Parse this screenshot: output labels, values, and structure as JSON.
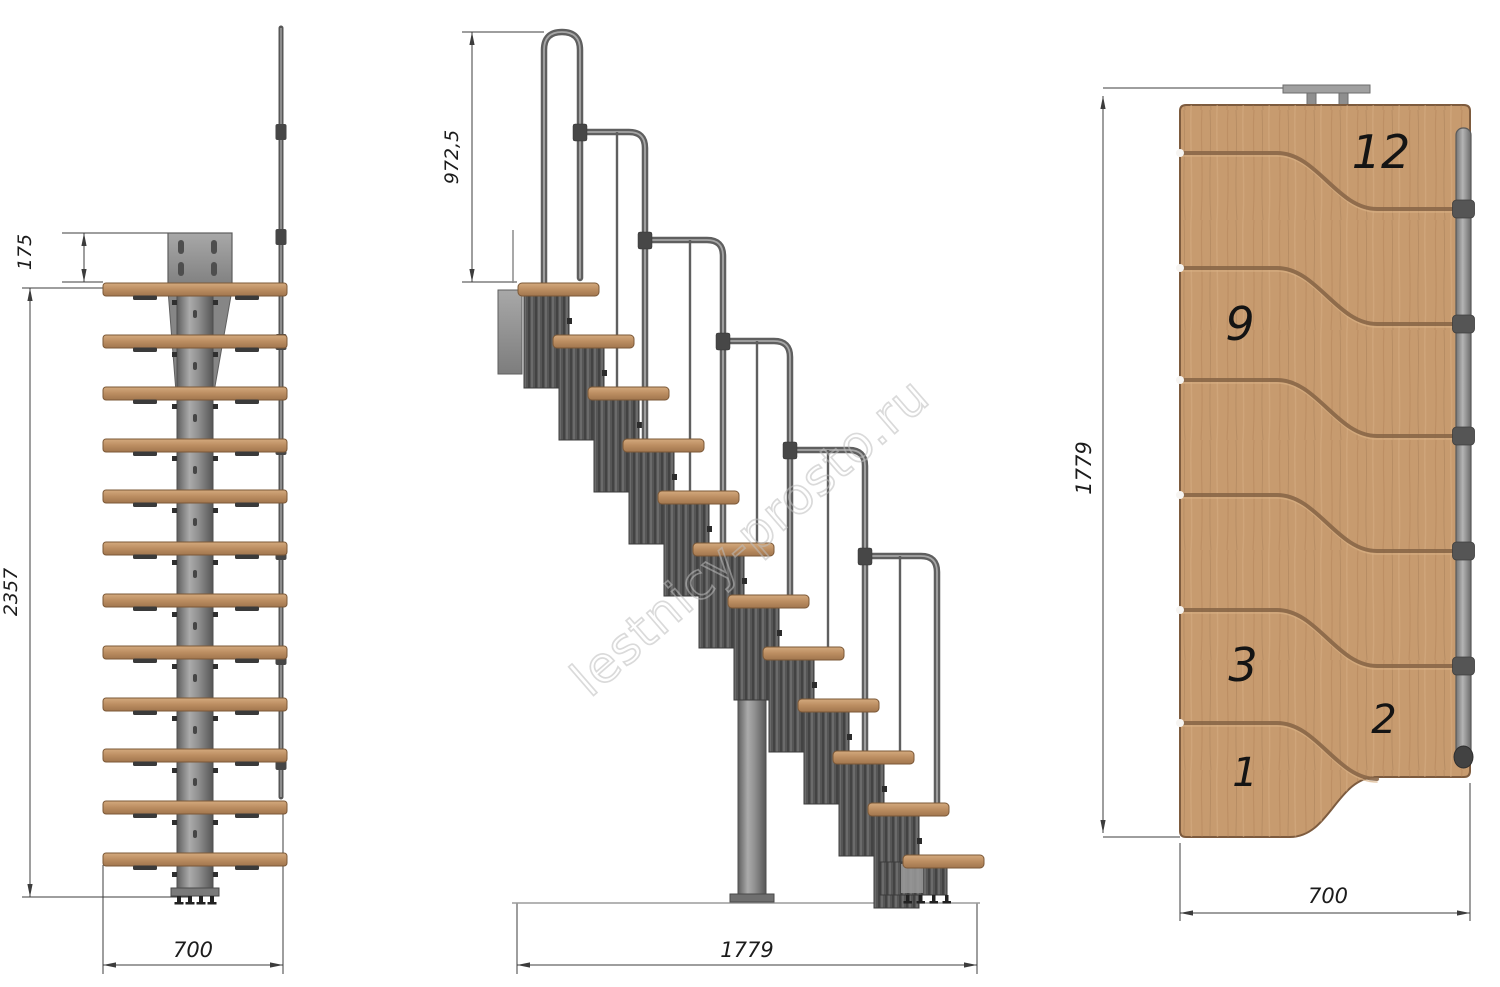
{
  "watermark": {
    "text": "lestnicy-prosto.ru"
  },
  "views": {
    "front": {
      "name": "front-elevation",
      "dims": {
        "offset_top": "175",
        "total_height": "2357",
        "width": "700"
      }
    },
    "side": {
      "name": "side-elevation",
      "dims": {
        "handrail_height": "972,5",
        "total_length": "1779"
      }
    },
    "plan": {
      "name": "top-plan",
      "dims": {
        "total_length": "1779",
        "width": "700"
      },
      "step_labels": [
        {
          "label": "12"
        },
        {
          "label": "9"
        },
        {
          "label": "3"
        },
        {
          "label": "2"
        },
        {
          "label": "1"
        }
      ]
    }
  },
  "colors": {
    "background": "#ffffff",
    "wood_base": "#c79b6f",
    "wood_tread_top": "#d4aa7e",
    "wood_tread_dark": "#a1764e",
    "wood_groove": "#8a6748",
    "metal_light": "#ababab",
    "metal_mid": "#8f8f8f",
    "metal_dark": "#5f5f5f",
    "module_dark": "#4a4a4a",
    "dim_line": "#3c3c3c",
    "label_text": "#1c1c1c",
    "watermark_gray": "#bdbdbd"
  }
}
